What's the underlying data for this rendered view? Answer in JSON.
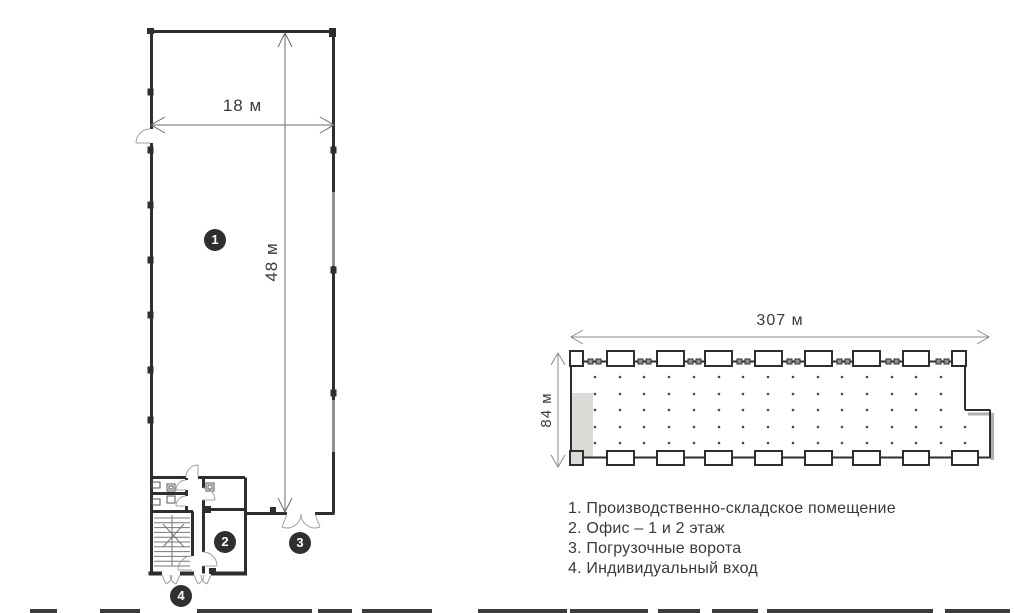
{
  "unit_plan": {
    "width_label": "18 м",
    "height_label": "48 м",
    "markers": [
      {
        "id": "production-area",
        "label": "1"
      },
      {
        "id": "office",
        "label": "2"
      },
      {
        "id": "loading-gate",
        "label": "3"
      },
      {
        "id": "individual-entrance",
        "label": "4"
      }
    ]
  },
  "site_plan": {
    "width_label": "307 м",
    "height_label": "84 м",
    "grid": {
      "cols_x": [
        595,
        620,
        644,
        669,
        694,
        719,
        743,
        768,
        793,
        818,
        842,
        867,
        892,
        916,
        941
      ],
      "rows_y": [
        377,
        394,
        410,
        427,
        443
      ],
      "extra_dots": [
        [
          965,
          427
        ],
        [
          965,
          443
        ]
      ]
    }
  },
  "legend": {
    "items": [
      "1. Производственно-складское помещение",
      "2. Офис – 1 и 2 этаж",
      "3. Погрузочные ворота",
      "4. Индивидуальный вход"
    ]
  },
  "colors": {
    "line": "#2e2e2e",
    "dimension": "#6b6b6b",
    "highlight_fill": "#d9dcd7",
    "text": "#3a3a3a",
    "marker_bg": "#2f2f2f"
  }
}
